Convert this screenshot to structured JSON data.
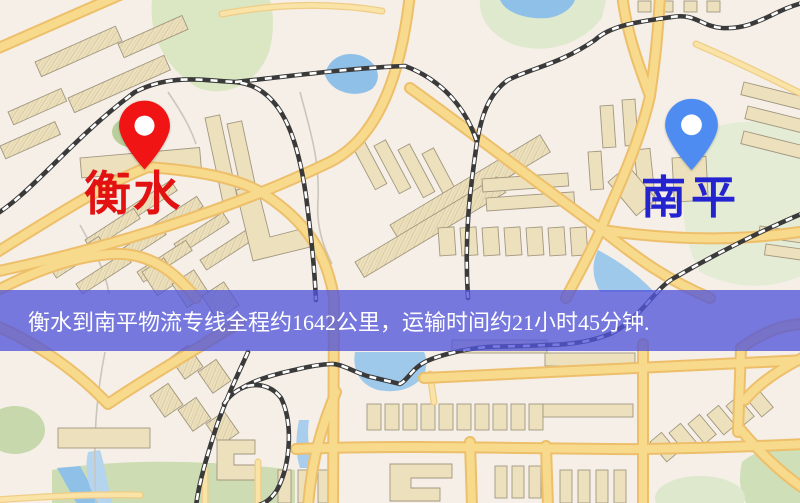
{
  "canvas": {
    "width": 800,
    "height": 503
  },
  "origin": {
    "label": "衡水",
    "pin_color": "#f01414",
    "label_color": "#e31212"
  },
  "destination": {
    "label": "南平",
    "pin_color": "#4e8cf2",
    "label_color": "#2323cf"
  },
  "banner": {
    "text": "衡水到南平物流专线全程约1642公里，运输时间约21小时45分钟.",
    "background_color": "#5256da",
    "background_opacity": "0.78",
    "text_color": "#ffffff"
  },
  "map_palette": {
    "background": "#f5efe7",
    "road_fill": "#f8da8c",
    "road_casing": "#edbf6b",
    "building_fill": "#ece0bd",
    "building_outline": "#a2977f",
    "park_green": "#dbe7c3",
    "water_blue": "#8fc0e8",
    "railway_dark": "#3a3a3a",
    "railway_dash": "#ffffff"
  }
}
